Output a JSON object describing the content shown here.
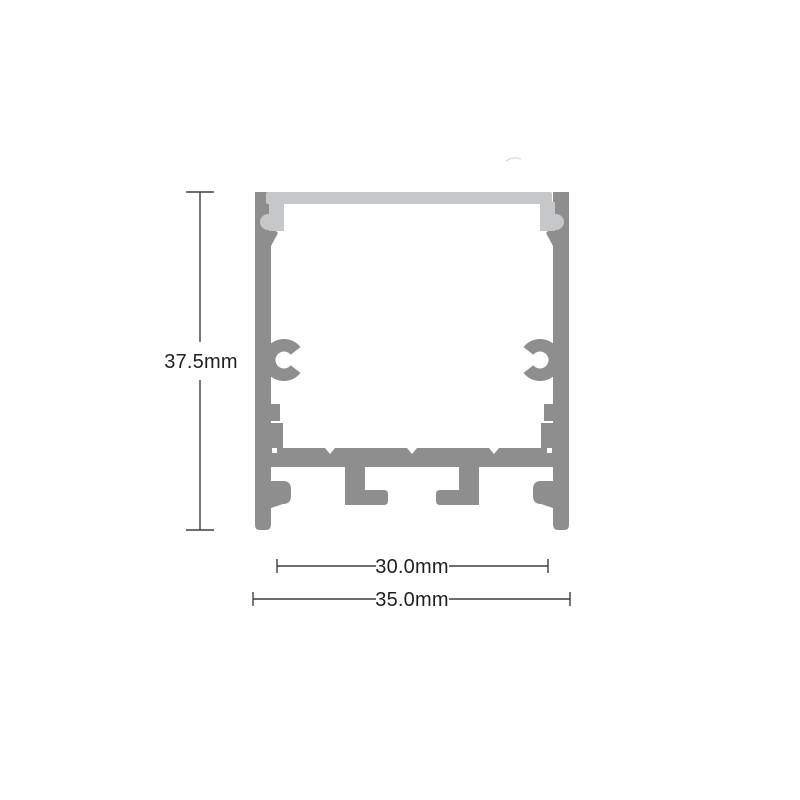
{
  "figure": {
    "dimensions": {
      "height_label": "37.5mm",
      "inner_width_label": "30.0mm",
      "outer_width_label": "35.0mm"
    },
    "colors": {
      "aluminum": "#8e8e8e",
      "diffuser": "#c6c7c9",
      "dimension_line": "#3f3f3f",
      "dimension_text": "#1f1f1f",
      "background": "#ffffff",
      "artifact": "#d9d9d9"
    }
  }
}
